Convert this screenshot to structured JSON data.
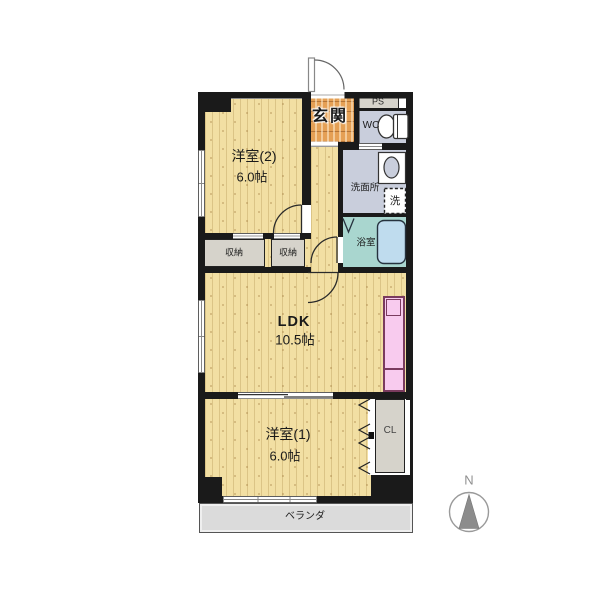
{
  "rooms": {
    "entrance": {
      "name": "玄関"
    },
    "pipe_space": {
      "name": "PS"
    },
    "toilet": {
      "name": "WC"
    },
    "washroom": {
      "name": "洗面所"
    },
    "laundry": {
      "name": "洗"
    },
    "bathroom": {
      "name": "浴室"
    },
    "western2": {
      "name": "洋室(2)",
      "size": "6.0帖"
    },
    "storage_left": {
      "name": "収納"
    },
    "storage_right": {
      "name": "収納"
    },
    "ldk": {
      "name": "LDK",
      "size": "10.5帖"
    },
    "western1": {
      "name": "洋室(1)",
      "size": "6.0帖"
    },
    "closet": {
      "name": "CL"
    },
    "balcony": {
      "name": "ベランダ"
    }
  },
  "compass": {
    "north_label": "N"
  },
  "colors": {
    "wood": "#F2DFA3",
    "wood_line": "rgba(176,146,80,0.35)",
    "wood_dot": "rgba(160,120,60,0.45)",
    "tile": "#E5A055",
    "water": "#C9CEDC",
    "bath": "#A9D6CF",
    "tub": "#BFDCEE",
    "closet": "#D6D3CB",
    "kitchen": "#F8CBEE",
    "kitchen_line": "#7A3B5E",
    "wall": "#1A1A1A",
    "veranda": "#DBDBDB",
    "text": "#1A1A1A",
    "compass_gray": "#8C8C8C"
  }
}
